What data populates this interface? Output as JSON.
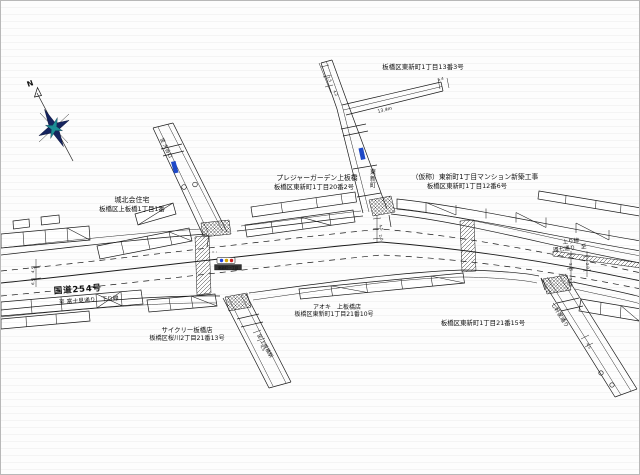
{
  "colors": {
    "line": "#1a1a1a",
    "sign_blue": "#1e49c8",
    "compass_navy": "#15245f",
    "compass_teal": "#1d8f96",
    "signal_red": "#cc2222",
    "signal_yellow": "#d9a800",
    "signal_blue": "#2244dd",
    "plate_dark": "#333333"
  },
  "compass": {
    "north_label": "N"
  },
  "labels": [
    {
      "name": "compass-north-label",
      "text": "N",
      "x": 27,
      "y": 86,
      "size": 7.5,
      "rot": -20,
      "weight": "bold"
    },
    {
      "name": "address-higashishinmachi-1-13-3",
      "text": "板橋区東新町1丁目13番3号",
      "x": 422,
      "y": 68,
      "size": 6.5,
      "anchor": "middle"
    },
    {
      "name": "pleasure-garden-name",
      "text": "プレジャーガーデン上板橋",
      "x": 316,
      "y": 179,
      "size": 6.8,
      "anchor": "middle"
    },
    {
      "name": "pleasure-garden-address",
      "text": "板橋区東新町1丁目20番2号",
      "x": 313,
      "y": 188,
      "size": 6.4,
      "anchor": "middle"
    },
    {
      "name": "construction-site-name",
      "text": "（仮称）東新町1丁目マンション新築工事",
      "x": 474,
      "y": 178,
      "size": 6.8,
      "anchor": "middle"
    },
    {
      "name": "construction-site-address",
      "text": "板橋区東新町1丁目12番6号",
      "x": 466,
      "y": 187,
      "size": 6.4,
      "anchor": "middle"
    },
    {
      "name": "johoku-housing-name",
      "text": "城北会住宅",
      "x": 131,
      "y": 201,
      "size": 7,
      "anchor": "middle"
    },
    {
      "name": "johoku-housing-address",
      "text": "板橋区上板橋1丁目1番",
      "x": 131,
      "y": 210,
      "size": 6.4,
      "anchor": "middle"
    },
    {
      "name": "route-254-label",
      "text": "国道254号",
      "x": 77,
      "y": 291,
      "size": 8.5,
      "anchor": "middle",
      "rot": -4,
      "weight": "bold",
      "ls": 0.8
    },
    {
      "name": "kudari-direction-label",
      "text": "至 富士見通り　下り線",
      "x": 88,
      "y": 301,
      "size": 5.8,
      "anchor": "middle",
      "rot": -4
    },
    {
      "name": "cyclely-shop-name",
      "text": "サイクリー板橋店",
      "x": 186,
      "y": 331,
      "size": 6.4,
      "anchor": "middle"
    },
    {
      "name": "cyclely-shop-address",
      "text": "板橋区桜川2丁目21番13号",
      "x": 186,
      "y": 339,
      "size": 6.2,
      "anchor": "middle"
    },
    {
      "name": "aoki-shop-name",
      "text": "アオキ　上板橋店",
      "x": 336,
      "y": 308,
      "size": 6,
      "anchor": "middle"
    },
    {
      "name": "aoki-shop-address",
      "text": "板橋区東新町1丁目21番10号",
      "x": 333,
      "y": 315,
      "size": 6,
      "anchor": "middle"
    },
    {
      "name": "address-higashishinmachi-1-21-15",
      "text": "板橋区東新町1丁目21番15号",
      "x": 482,
      "y": 324,
      "size": 6.4,
      "anchor": "middle"
    },
    {
      "name": "nobori-lane-label",
      "text": "上り線",
      "x": 570,
      "y": 242,
      "size": 5.6,
      "anchor": "middle",
      "rot": -7
    },
    {
      "name": "kannana-direction-label",
      "text": "環七通り　至",
      "x": 569,
      "y": 249,
      "size": 5.6,
      "anchor": "middle",
      "rot": -7
    },
    {
      "name": "signal-name-plate-text",
      "text": "東新町一丁目",
      "x": 227,
      "y": 267.8,
      "size": 3.4,
      "anchor": "middle",
      "color": "#ffffff"
    },
    {
      "name": "road-name-vertical-higashishinmachi",
      "text": "東新町",
      "x": 369,
      "y": 173,
      "size": 6,
      "vertical": true
    },
    {
      "name": "road-name-shichikenya-dori",
      "text": "七軒家通り",
      "x": 550,
      "y": 303,
      "size": 5.6,
      "rot": 58
    },
    {
      "name": "to-kamiitabashi-station-label",
      "text": "至 上板橋駅",
      "x": 256,
      "y": 334,
      "size": 5,
      "rot": 60
    },
    {
      "name": "to-oyaguchi-label",
      "text": "至 大谷口",
      "x": 159,
      "y": 138,
      "size": 5,
      "rot": 64
    },
    {
      "name": "dim-13-4m-label",
      "text": "13.4m",
      "x": 377,
      "y": 112,
      "size": 4.6,
      "rot": -14
    }
  ],
  "dims": [
    {
      "name": "dim-4-5-left",
      "text": "4.5",
      "x": 33,
      "y": 272,
      "rot": -84
    },
    {
      "name": "dim-6-5-left",
      "text": "6.5",
      "x": 33,
      "y": 284,
      "rot": -84
    },
    {
      "name": "dim-1-5-top",
      "text": "1.5",
      "x": 326,
      "y": 76,
      "rot": 66
    },
    {
      "name": "dim-4-2-top",
      "text": "4.2",
      "x": 332,
      "y": 90,
      "rot": 66
    },
    {
      "name": "dim-5-4-branch",
      "text": "5.4",
      "x": 437,
      "y": 80,
      "rot": -14
    },
    {
      "name": "dim-4-5-mid",
      "text": "4.5",
      "x": 378,
      "y": 224,
      "rot": 72
    },
    {
      "name": "dim-2-0-mid",
      "text": "2.0",
      "x": 378,
      "y": 234,
      "rot": 72
    },
    {
      "name": "dim-3-25-right-a",
      "text": "3.25",
      "x": 568,
      "y": 262,
      "rot": 84
    },
    {
      "name": "dim-3-25-right-b",
      "text": "3.25",
      "x": 568,
      "y": 277,
      "rot": 84
    },
    {
      "name": "dim-2-0-right",
      "text": "2.0",
      "x": 585,
      "y": 262,
      "rot": 84
    },
    {
      "name": "dim-4-5-lowerleft",
      "text": "4.5",
      "x": 259,
      "y": 345,
      "rot": 60
    },
    {
      "name": "dim-4-5-lowerright",
      "text": "4.5",
      "x": 585,
      "y": 343,
      "rot": 58
    }
  ]
}
